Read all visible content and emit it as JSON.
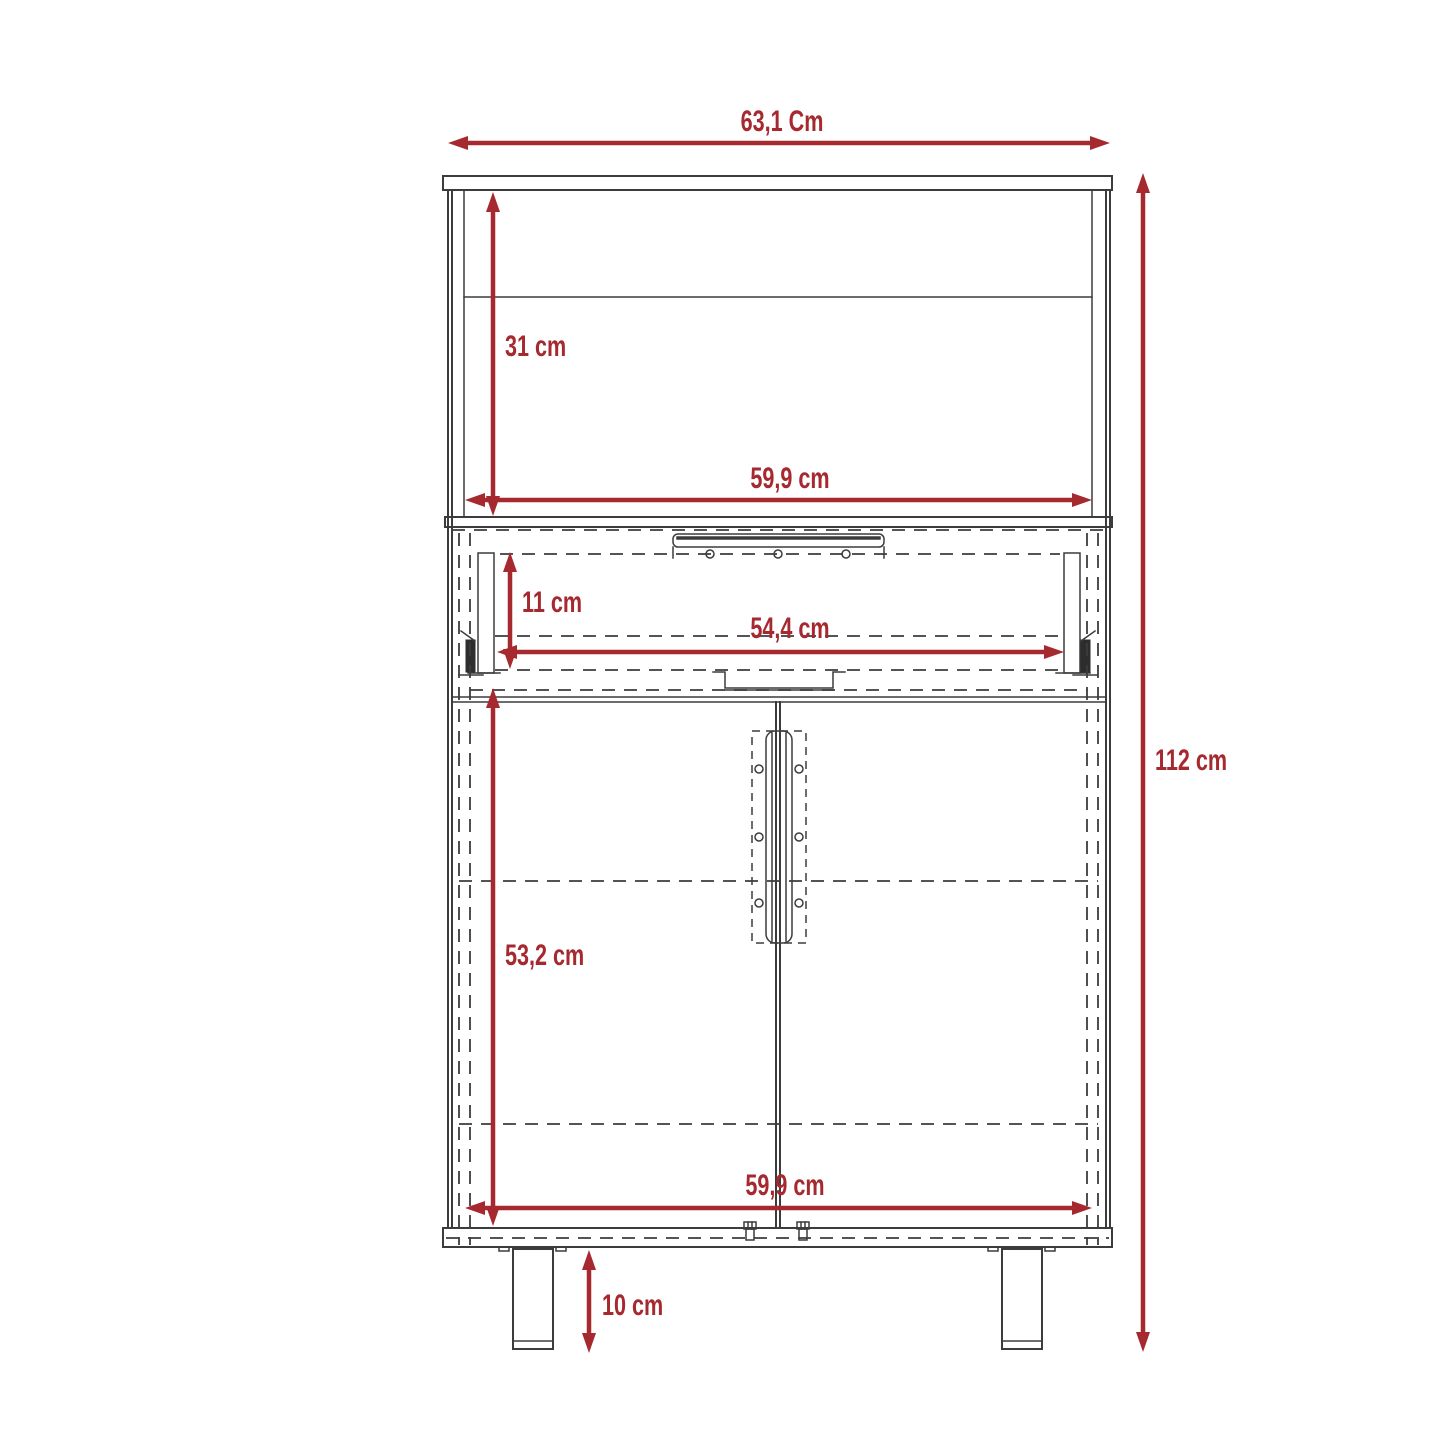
{
  "diagram": {
    "colors": {
      "dimension_accent": "#a5292e",
      "drawing_line": "#3c3c3c",
      "background": "#ffffff"
    },
    "dimensions": {
      "top_width": {
        "label": "63,1 Cm"
      },
      "hutch_height": {
        "label": "31 cm"
      },
      "upper_inner_width": {
        "label": "59,9 cm"
      },
      "drawer_height": {
        "label": "11 cm"
      },
      "drawer_width": {
        "label": "54,4 cm"
      },
      "door_section_height": {
        "label": "53,2 cm"
      },
      "lower_inner_width": {
        "label": "59,9 cm"
      },
      "leg_height": {
        "label": "10 cm"
      },
      "total_height": {
        "label": "112 cm"
      }
    }
  }
}
